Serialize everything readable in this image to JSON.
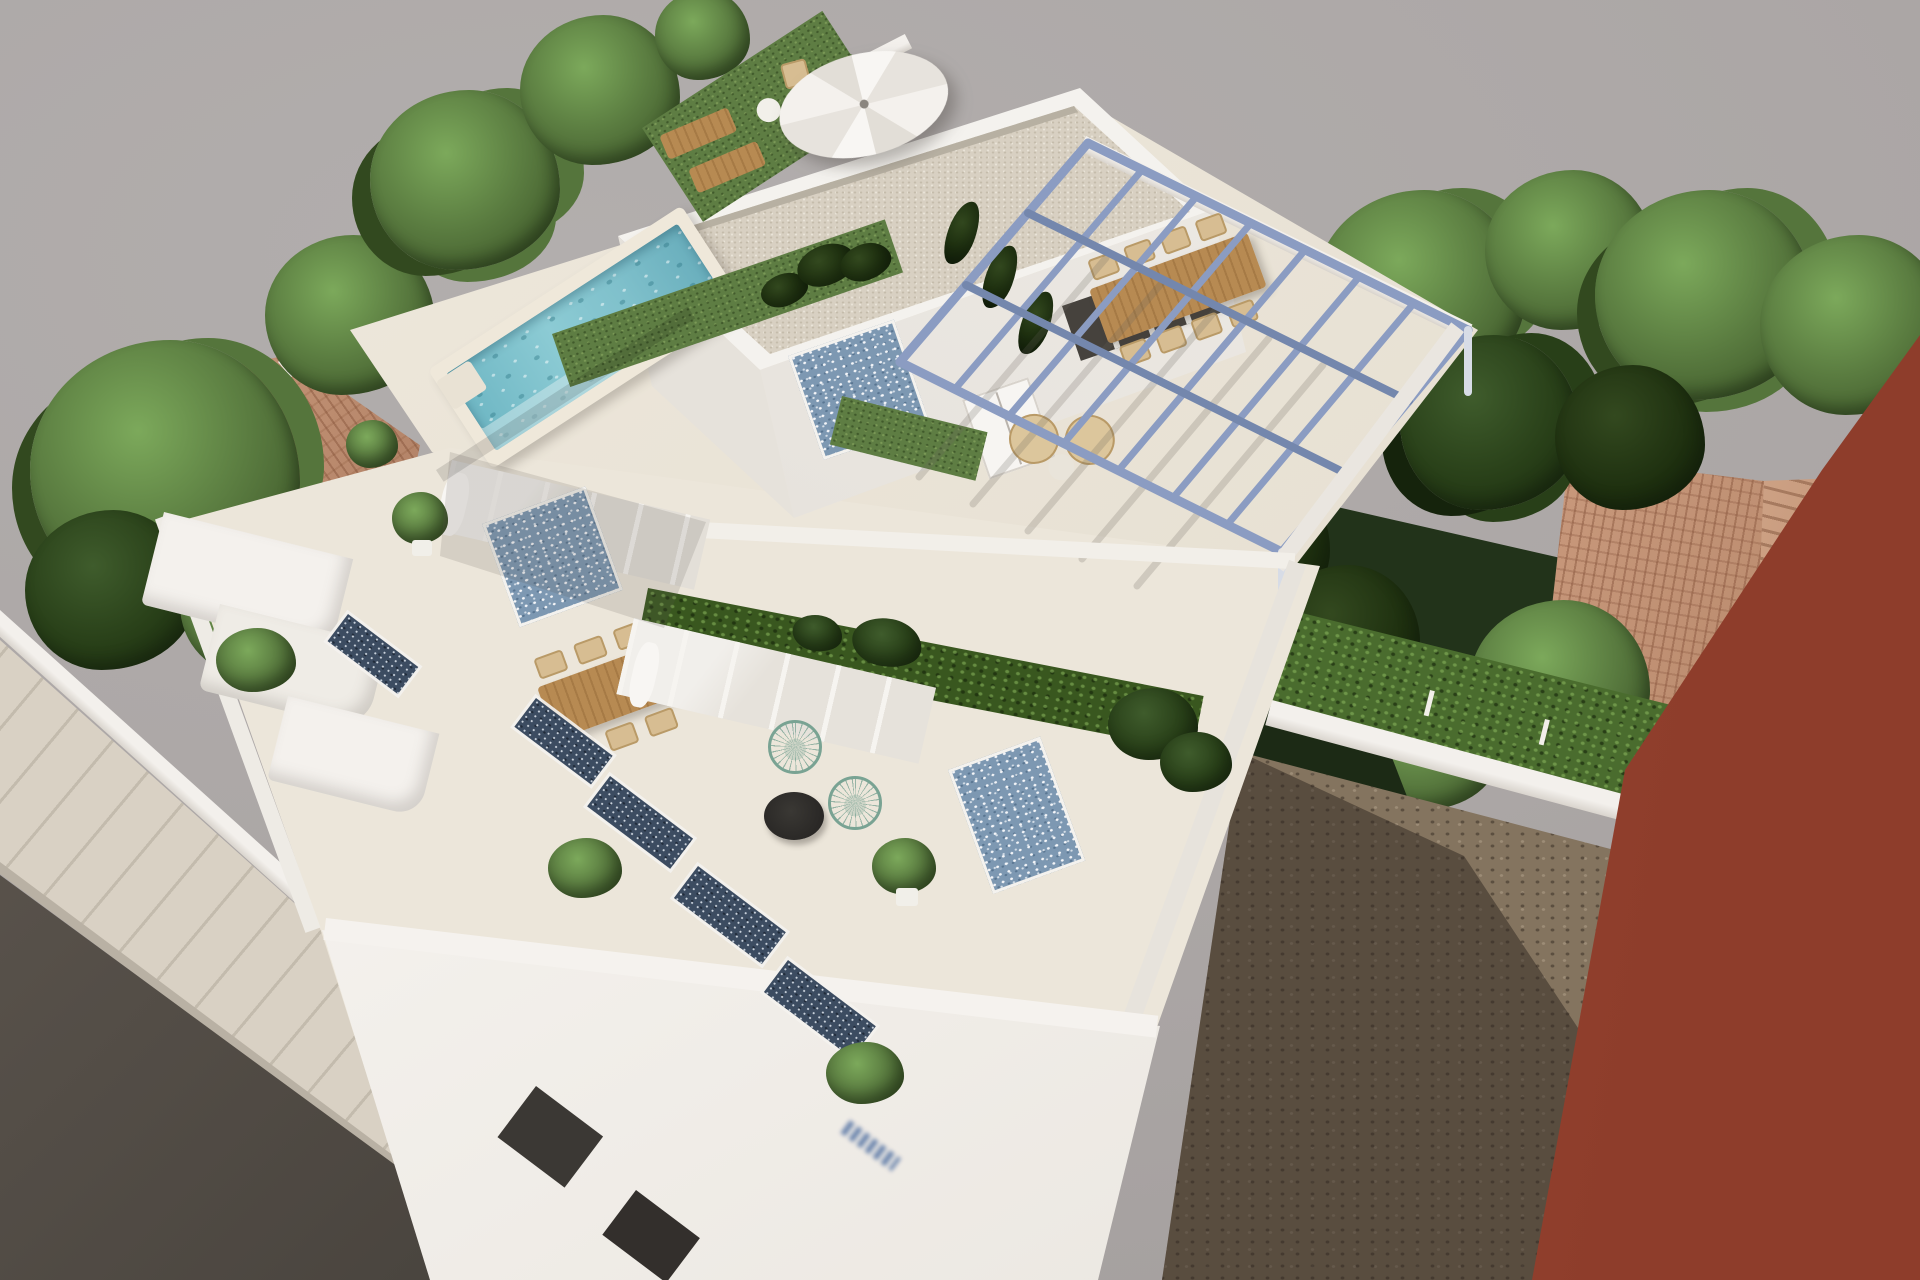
{
  "scene": {
    "subject": "Aerial 3D architectural rendering of a modern two-storey white villa with rooftop pool, blue steel pergola and tiled terraces",
    "view": "high aerial three-quarter view, building rotated diagonally",
    "style": "photoreal CGI visualization on neutral grey backdrop"
  },
  "palette": {
    "backdrop": "#aeaaa9",
    "villa_white": "#f3f1ed",
    "wall_shade": "#ddd8d1",
    "pool_water": "#7fc0cb",
    "pool_coping": "#efe8da",
    "lawn_green": "#5e7d43",
    "hedge_dark": "#2c421f",
    "tree_green": "#6f9a4d",
    "pergola_steel": "#8b9cc2",
    "wood_furniture": "#b5854f",
    "tile_accent_blue": "#7d98b2",
    "curtain_navy": "#3c4c61",
    "gravel_roof": "#d8d0c2",
    "terracotta_roof": "#c0906f",
    "red_building": "#a24a36",
    "dirt_lot": "#7b6c5b",
    "road_asphalt": "#49443e",
    "sidewalk": "#d9d1c4",
    "acapulco_chair_wire": "#79a393"
  },
  "elements": {
    "backdrop": "Neutral grey studio backdrop",
    "road": "Dark asphalt street at lower left",
    "sidewalk": "Light paved sidewalk with joint lines",
    "villa": "White two-storey villa with stepped terraces",
    "pool": "Rooftop plunge pool with turquoise water and cream coping",
    "umbrella": "White octagonal patio umbrella",
    "loungers": "Wooden sun loungers on rooftop lawn",
    "penthouse": "Rooftop penthouse volume with speckled gravel flat roof",
    "tile_accent": "Blue-and-white patterned tile accent wall",
    "pergola": "Steel-blue pergola frame over roof dining terrace",
    "dining_set": "Wooden outdoor dining table with wicker chairs",
    "mid_terrace": "First-floor terrace with wooden dining table and sliding glass doors",
    "acapulco_chairs": "Two teal wire lounge chairs with round black table",
    "facade_windows": "Street-facade window slots with navy patterned curtains",
    "facade_sign": "Small illegible blue lettering on the street facade",
    "front_bushes": "Green shrubs along the street boundary wall",
    "left_neighbor_roof": "Neighbouring terracotta hip roof among trees",
    "right_neighbor_roofs": "Neighbouring terracotta tiled roofs among dense trees",
    "garden_hedge": "Bright clipped hedge with small white fence posts",
    "dirt_lot": "Vacant brown dirt plot with cast building shadow",
    "red_building": "Adjacent rust-red building wall at far right",
    "boundary_wall": "White rear boundary wall with trees behind"
  }
}
